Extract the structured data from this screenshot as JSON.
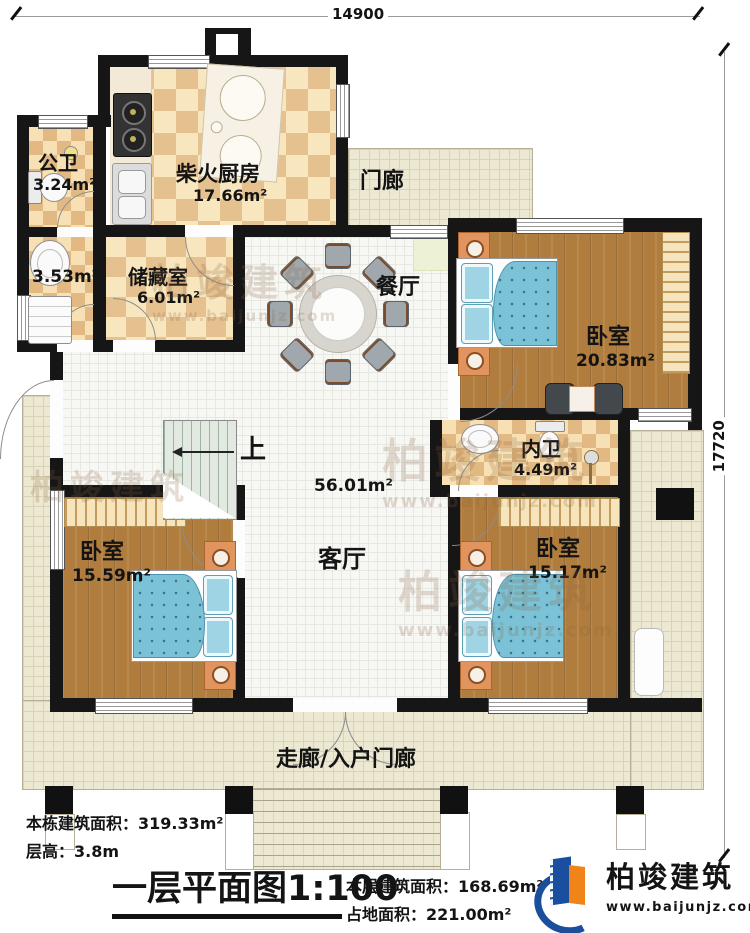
{
  "dimensions": {
    "width_mm": "14900",
    "height_mm": "17720"
  },
  "rooms": {
    "public_bath": {
      "name": "公卫",
      "area": "3.24m²"
    },
    "side_room": {
      "area": "3.53m²"
    },
    "kitchen": {
      "name": "柴火厨房",
      "area": "17.66m²"
    },
    "porch": {
      "name": "门廊"
    },
    "storage": {
      "name": "储藏室",
      "area": "6.01m²"
    },
    "dining": {
      "name": "餐厅"
    },
    "bedroom_ne": {
      "name": "卧室",
      "area": "20.83m²"
    },
    "inner_bath": {
      "name": "内卫",
      "area": "4.49m²"
    },
    "living": {
      "name": "客厅",
      "area": "56.01m²"
    },
    "bedroom_sw": {
      "name": "卧室",
      "area": "15.59m²"
    },
    "bedroom_se": {
      "name": "卧室",
      "area": "15.17m²"
    },
    "entry_porch": {
      "name": "走廊/入户门廊"
    },
    "stairs": {
      "up_label": "上"
    }
  },
  "notes": {
    "total_area_label": "本栋建筑面积：",
    "total_area_value": "319.33m²",
    "floor_height_label": "层高：",
    "floor_height_value": "3.8m"
  },
  "title_block": {
    "title": "一层平面图",
    "scale": "1:100",
    "floor_area_label": "本层建筑面积：",
    "floor_area_value": "168.69m²",
    "footprint_label": "占地面积：",
    "footprint_value": "221.00m²"
  },
  "brand": {
    "name": "柏竣建筑",
    "website": "www.baijunjz.com"
  },
  "watermark": {
    "name": "柏竣建筑",
    "website": "www.baijunjz.com"
  }
}
